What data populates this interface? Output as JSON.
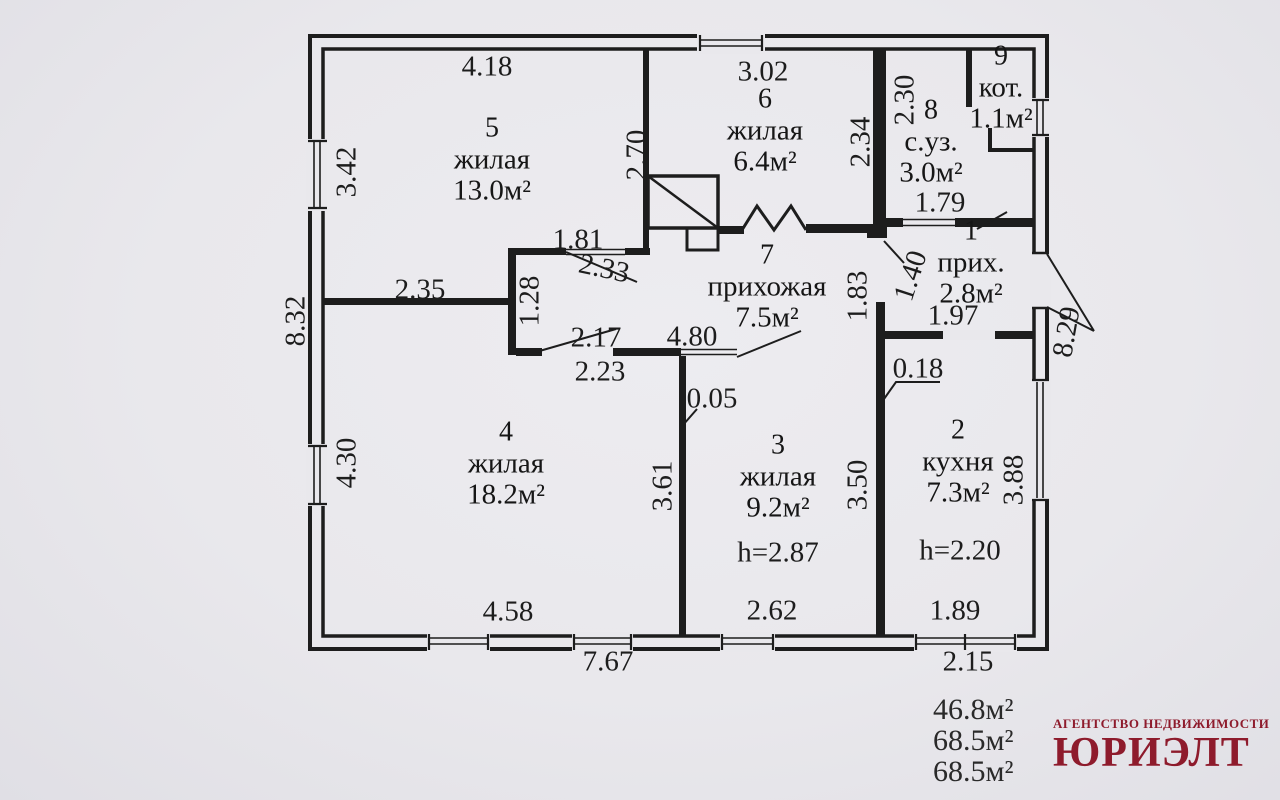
{
  "colors": {
    "paper": "#e9e8ec",
    "ink": "#1d1d1d",
    "logo_red": "#8e1b2c"
  },
  "rooms": [
    {
      "number": "5",
      "name": "жилая",
      "area": "13.0м²"
    },
    {
      "number": "6",
      "name": "жилая",
      "area": "6.4м²"
    },
    {
      "number": "9",
      "name": "кот.",
      "area": "1.1м²"
    },
    {
      "number": "8",
      "name": "с.уз.",
      "area": "3.0м²"
    },
    {
      "number": "1",
      "name": "прих.",
      "area": "2.8м²"
    },
    {
      "number": "7",
      "name": "прихожая",
      "area": "7.5м²"
    },
    {
      "number": "4",
      "name": "жилая",
      "area": "18.2м²"
    },
    {
      "number": "3",
      "name": "жилая",
      "area": "9.2м²",
      "height": "h=2.87"
    },
    {
      "number": "2",
      "name": "кухня",
      "area": "7.3м²",
      "height": "h=2.20"
    }
  ],
  "dimensions": [
    {
      "label": "4.18"
    },
    {
      "label": "3.02"
    },
    {
      "label": "2.30"
    },
    {
      "label": "1.79"
    },
    {
      "label": "3.42"
    },
    {
      "label": "2.70"
    },
    {
      "label": "2.34"
    },
    {
      "label": "1.81"
    },
    {
      "label": "2.33"
    },
    {
      "label": "2.35"
    },
    {
      "label": "1.28"
    },
    {
      "label": "2.17"
    },
    {
      "label": "2.23"
    },
    {
      "label": "4.80"
    },
    {
      "label": "0.05"
    },
    {
      "label": "1.83"
    },
    {
      "label": "1.40"
    },
    {
      "label": "1.97"
    },
    {
      "label": "0.18"
    },
    {
      "label": "8.29"
    },
    {
      "label": "8.32"
    },
    {
      "label": "4.30"
    },
    {
      "label": "3.61"
    },
    {
      "label": "3.50"
    },
    {
      "label": "3.88"
    },
    {
      "label": "4.58"
    },
    {
      "label": "2.62"
    },
    {
      "label": "1.89"
    },
    {
      "label": "7.67"
    },
    {
      "label": "2.15"
    }
  ],
  "totals": {
    "line1": "46.8м²",
    "line2": "68.5м²",
    "line3": "68.5м²"
  },
  "logo": {
    "tagline": "АГЕНТСТВО НЕДВИЖИМОСТИ",
    "name": "ЮРИЭЛТ"
  }
}
